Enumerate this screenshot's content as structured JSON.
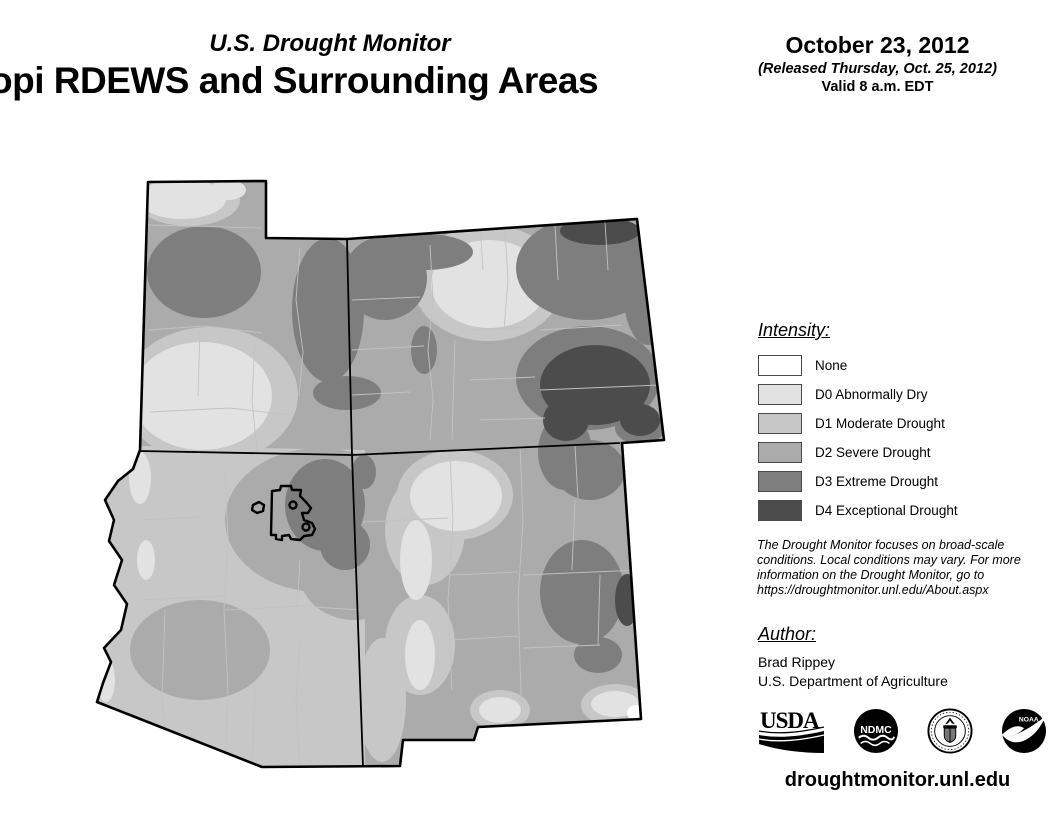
{
  "header": {
    "program_title": "U.S. Drought Monitor",
    "map_title": "opi RDEWS and Surrounding Areas",
    "date": "October 23, 2012",
    "release_note": "(Released Thursday, Oct. 25, 2012)",
    "valid_note": "Valid 8 a.m. EDT"
  },
  "legend": {
    "heading": "Intensity:",
    "items": [
      {
        "label": "None",
        "color": "#ffffff"
      },
      {
        "label": "D0 Abnormally Dry",
        "color": "#e2e2e2"
      },
      {
        "label": "D1 Moderate Drought",
        "color": "#c7c7c7"
      },
      {
        "label": "D2 Severe Drought",
        "color": "#ababab"
      },
      {
        "label": "D3 Extreme Drought",
        "color": "#7e7e7e"
      },
      {
        "label": "D4 Exceptional Drought",
        "color": "#4c4c4c"
      }
    ]
  },
  "notes": {
    "disclaimer": "The Drought Monitor focuses on broad-scale conditions. Local conditions may vary. For more information on the Drought Monitor, go to https://droughtmonitor.unl.edu/About.aspx"
  },
  "author": {
    "heading": "Author:",
    "name": "Brad Rippey",
    "organization": "U.S. Department of Agriculture"
  },
  "logos": {
    "usda_text": "USDA",
    "ndmc_text": "NDMC",
    "noaa_text": "NOAA"
  },
  "footer": {
    "url": "droughtmonitor.unl.edu"
  }
}
